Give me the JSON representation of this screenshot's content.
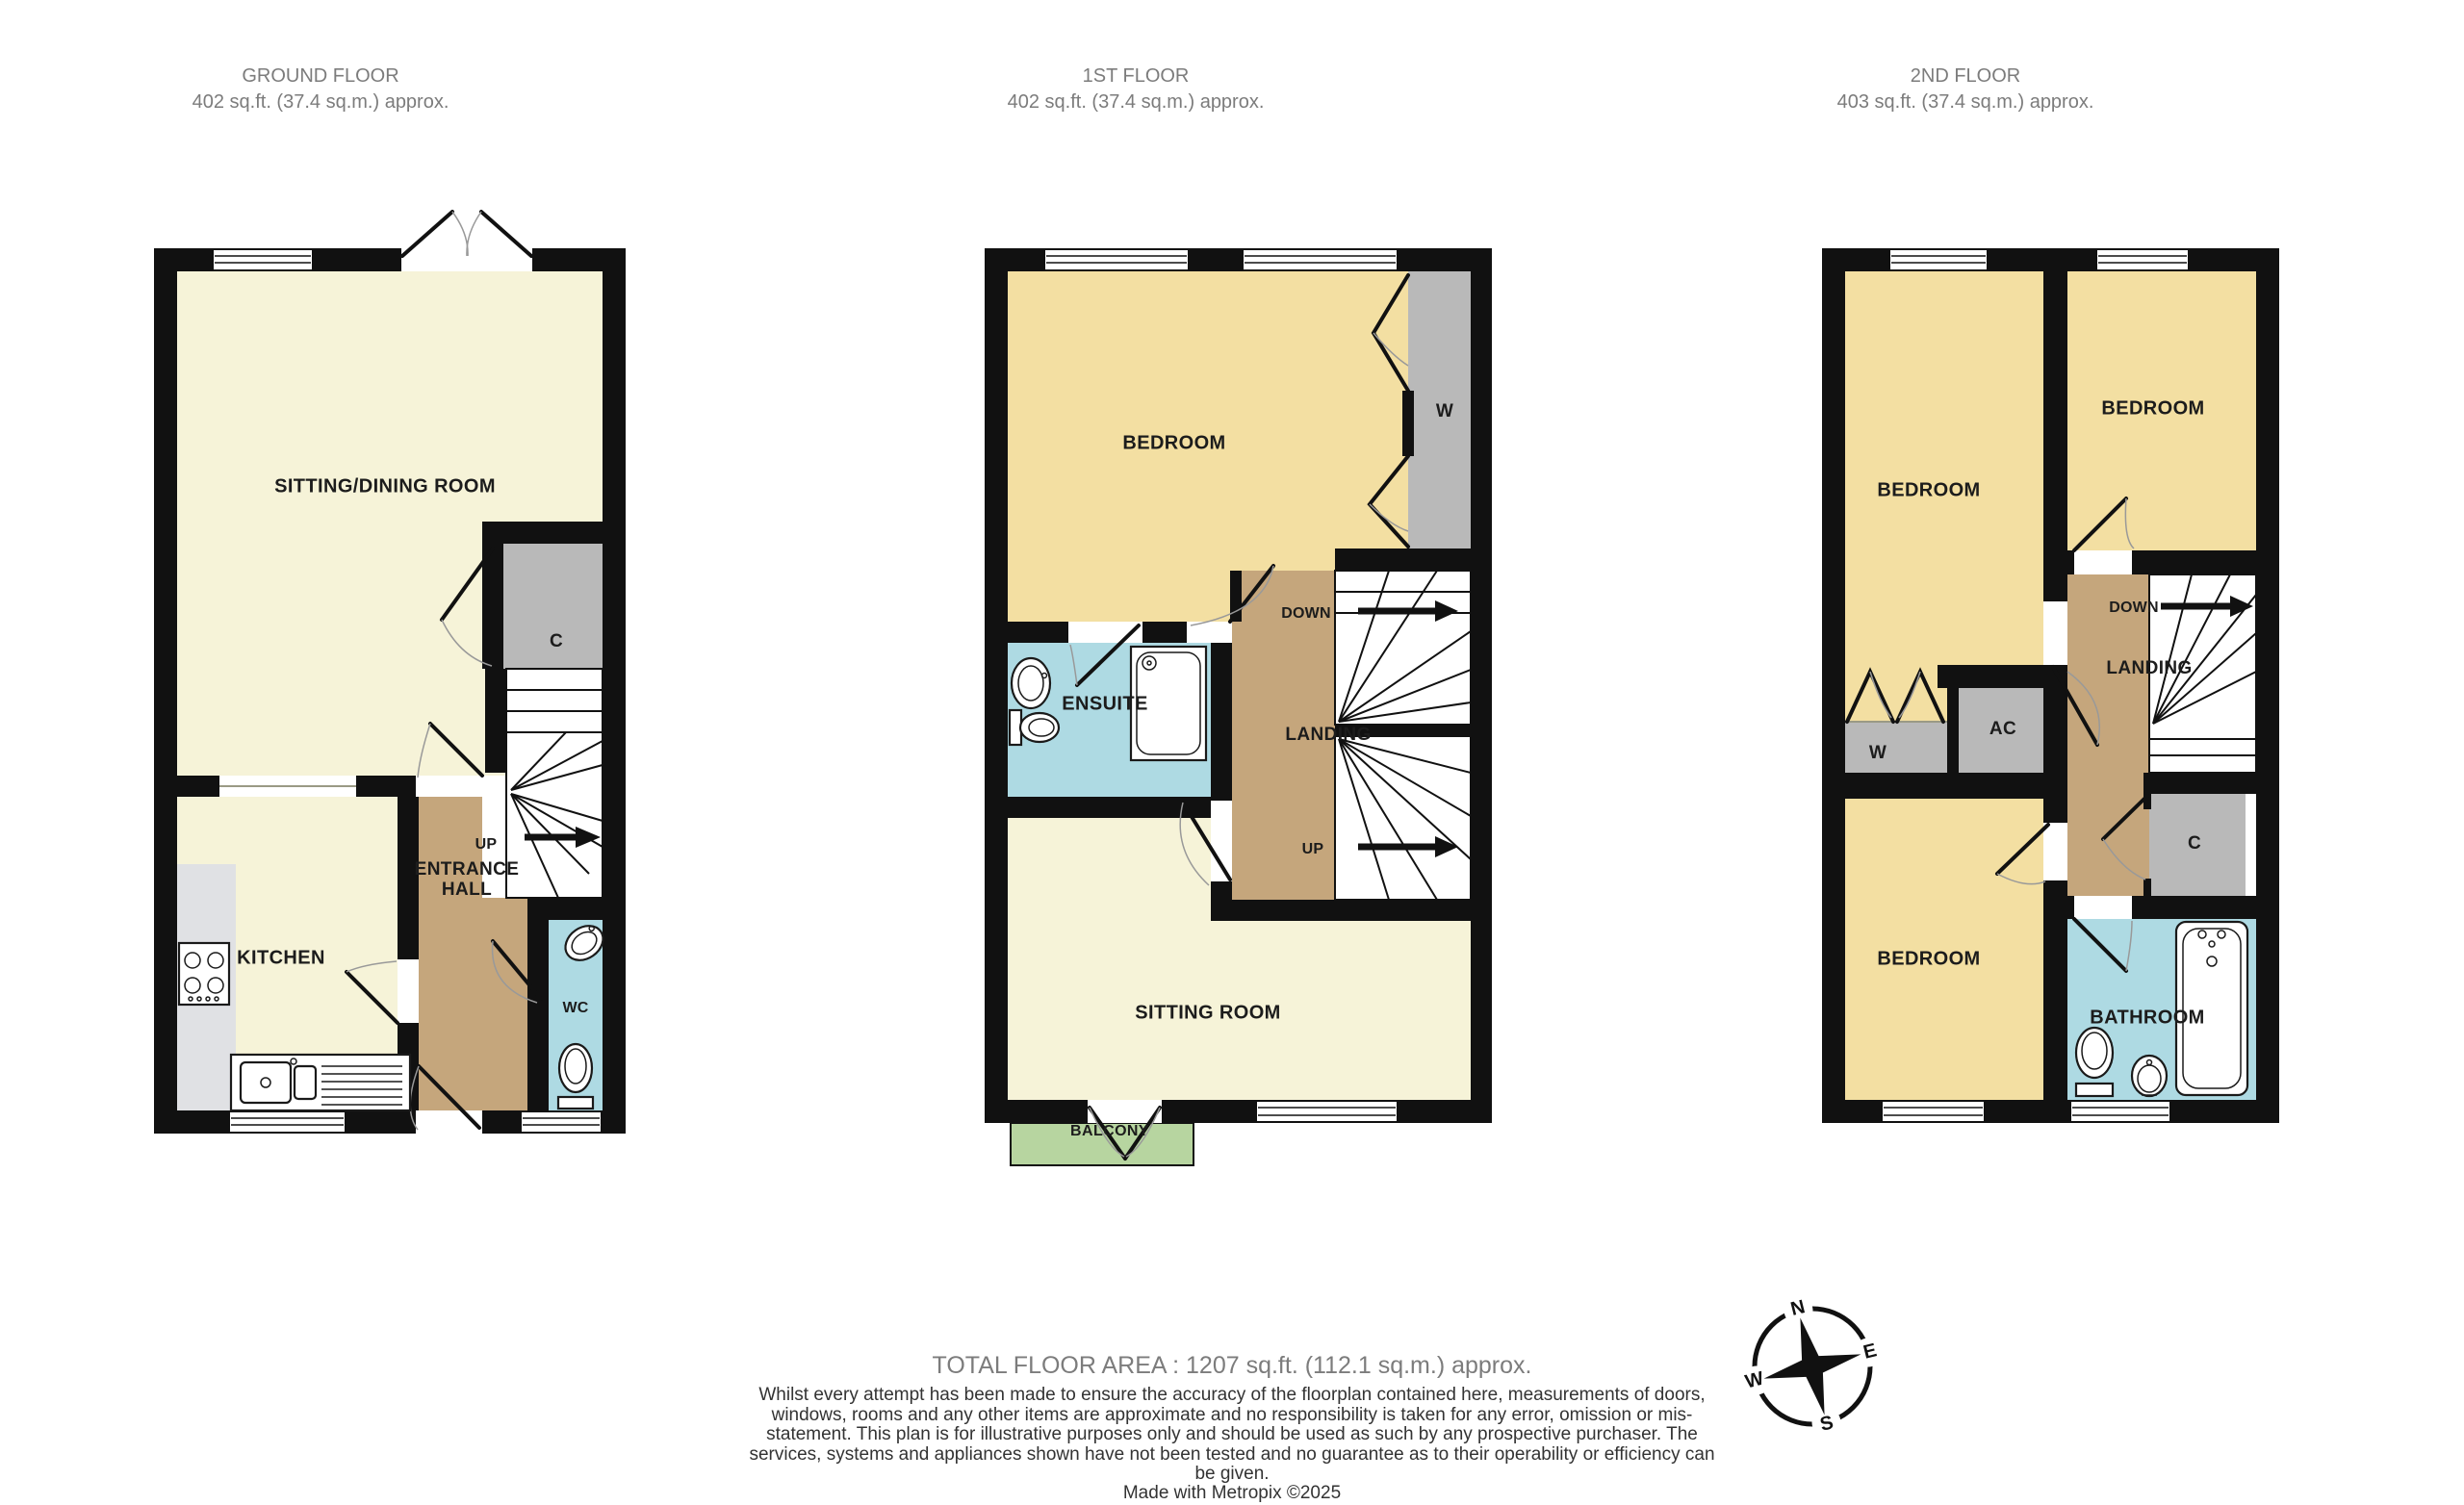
{
  "floors": [
    {
      "title": "GROUND FLOOR",
      "area": "402 sq.ft. (37.4 sq.m.) approx."
    },
    {
      "title": "1ST FLOOR",
      "area": "402 sq.ft. (37.4 sq.m.) approx."
    },
    {
      "title": "2ND FLOOR",
      "area": "403 sq.ft. (37.4 sq.m.) approx."
    }
  ],
  "ground_floor": {
    "labels": {
      "sitting_dining": "SITTING/DINING ROOM",
      "kitchen": "KITCHEN",
      "closet": "C",
      "up": "UP",
      "entrance_line1": "ENTRANCE",
      "entrance_line2": "HALL",
      "wc": "WC"
    }
  },
  "first_floor": {
    "labels": {
      "bedroom": "BEDROOM",
      "wardrobe": "W",
      "down": "DOWN",
      "landing": "LANDING",
      "ensuite": "ENSUITE",
      "up": "UP",
      "sitting_room": "SITTING ROOM",
      "balcony": "BALCONY"
    }
  },
  "second_floor": {
    "labels": {
      "bedroom_top_left": "BEDROOM",
      "bedroom_top_right": "BEDROOM",
      "bedroom_bottom": "BEDROOM",
      "wardrobe": "W",
      "ac": "AC",
      "down": "DOWN",
      "landing": "LANDING",
      "closet": "C",
      "bathroom": "BATHROOM"
    }
  },
  "compass": {
    "north": "N",
    "east": "E",
    "south": "S",
    "west": "W"
  },
  "footer": {
    "total_area": "TOTAL FLOOR AREA : 1207 sq.ft. (112.1 sq.m.) approx.",
    "disclaimer": "Whilst every attempt has been made to ensure the accuracy of the floorplan contained here, measurements of doors, windows, rooms and any other items are approximate and no responsibility is taken for any error, omission or mis-statement. This plan is for illustrative purposes only and should be used as such by any prospective purchaser. The services, systems and appliances shown have not been tested and no guarantee as to their operability or efficiency can be given.",
    "credit": "Made with Metropix ©2025"
  },
  "colors": {
    "wall": "#111111",
    "room_cream": "#f6f3d8",
    "room_yellow": "#f3dfa2",
    "hall_tan": "#c5a67c",
    "bath_blue": "#aedae3",
    "closet_gray": "#b9b9b9",
    "counter_gray": "#e0e1e4",
    "balcony_green": "#b7d5a0",
    "heading_gray": "#7c7c7c",
    "body_text": "#333333"
  }
}
